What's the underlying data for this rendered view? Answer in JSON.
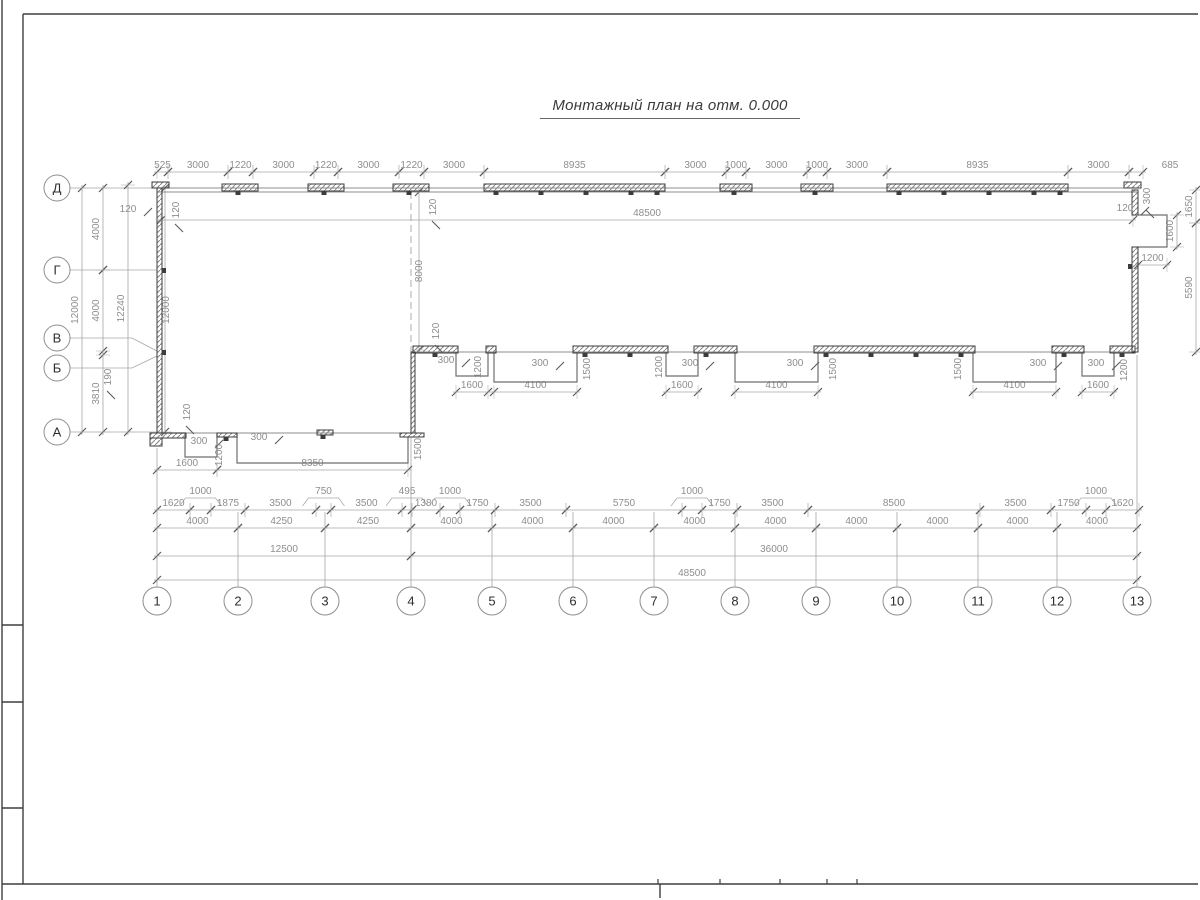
{
  "title": {
    "text": "Монтажный план на отм. 0.000"
  },
  "colors": {
    "wall": "#3c3c3c",
    "dim_line": "#a6a6a6",
    "tick": "#5a5a5a",
    "dim_text": "#8e8e8e",
    "axis_text": "#2f2f2f",
    "outline": "#6f6f6f",
    "frame": "#3f3f3f",
    "sheet_edge": "#9a9a9a",
    "hatch": "#8a8a8a"
  },
  "frame": {
    "lines": [
      [
        2,
        0,
        2,
        900
      ],
      [
        23,
        14,
        1198,
        14
      ],
      [
        23,
        14,
        23,
        884
      ],
      [
        2,
        884,
        1198,
        884
      ],
      [
        2,
        625,
        23,
        625
      ],
      [
        2,
        702,
        23,
        702
      ],
      [
        2,
        808,
        23,
        808
      ],
      [
        660,
        884,
        660,
        898
      ]
    ],
    "ticks_x": [
      658,
      720,
      780,
      827,
      857
    ],
    "ticks_y": 884
  },
  "axes": {
    "bottom": {
      "y": 601,
      "r": 14,
      "items": [
        {
          "label": "1",
          "x": 157
        },
        {
          "label": "2",
          "x": 238
        },
        {
          "label": "3",
          "x": 325
        },
        {
          "label": "4",
          "x": 411
        },
        {
          "label": "5",
          "x": 492
        },
        {
          "label": "6",
          "x": 573
        },
        {
          "label": "7",
          "x": 654
        },
        {
          "label": "8",
          "x": 735
        },
        {
          "label": "9",
          "x": 816
        },
        {
          "label": "10",
          "x": 897
        },
        {
          "label": "11",
          "x": 978
        },
        {
          "label": "12",
          "x": 1057
        },
        {
          "label": "13",
          "x": 1137
        }
      ]
    },
    "left": {
      "x": 57,
      "r": 13,
      "items": [
        {
          "label": "Д",
          "y": 188
        },
        {
          "label": "Г",
          "y": 270
        },
        {
          "label": "В",
          "y": 338
        },
        {
          "label": "Б",
          "y": 368
        },
        {
          "label": "А",
          "y": 432
        }
      ]
    }
  },
  "axis_lines": {
    "bottom_tops": [
      [
        157,
        448
      ],
      [
        238,
        512
      ],
      [
        325,
        512
      ],
      [
        411,
        437
      ],
      [
        492,
        512
      ],
      [
        573,
        512
      ],
      [
        654,
        512
      ],
      [
        735,
        512
      ],
      [
        816,
        512
      ],
      [
        897,
        512
      ],
      [
        978,
        512
      ],
      [
        1057,
        512
      ],
      [
        1137,
        355
      ]
    ],
    "bottom_end_y": 587,
    "left_leaders": [
      "70,188 157,188",
      "70,270 157,270",
      "70,338 132,338 157,351",
      "70,368 132,368 157,356",
      "70,432 157,432"
    ]
  },
  "chains": [
    {
      "o": "h",
      "p": 172,
      "segs": [
        [
          157,
          168,
          "525"
        ],
        [
          168,
          228,
          "3000"
        ],
        [
          228,
          253,
          "1220"
        ],
        [
          253,
          314,
          "3000"
        ],
        [
          314,
          338,
          "1220"
        ],
        [
          338,
          399,
          "3000"
        ],
        [
          399,
          424,
          "1220"
        ],
        [
          424,
          484,
          "3000"
        ],
        [
          484,
          665,
          "8935"
        ],
        [
          665,
          726,
          "3000"
        ],
        [
          726,
          746,
          "1000"
        ],
        [
          746,
          807,
          "3000"
        ],
        [
          807,
          827,
          "1000"
        ],
        [
          827,
          887,
          "3000"
        ],
        [
          887,
          1068,
          "8935"
        ],
        [
          1068,
          1129,
          "3000"
        ],
        [
          1129,
          1143,
          "685",
          1170
        ]
      ]
    },
    {
      "o": "h",
      "p": 220,
      "segs": [
        [
          161,
          1133,
          "48500",
          647
        ]
      ]
    },
    {
      "o": "h",
      "p": 510,
      "segs": [
        [
          157,
          190,
          "1620"
        ],
        [
          190,
          211,
          "1000",
          "r"
        ],
        [
          211,
          245,
          "1875"
        ],
        [
          245,
          316,
          "3500"
        ],
        [
          316,
          331,
          "750",
          "r"
        ],
        [
          331,
          402,
          "3500"
        ],
        [
          402,
          412,
          "495",
          "r"
        ],
        [
          412,
          440,
          "1380"
        ],
        [
          440,
          460,
          "1000",
          "r"
        ],
        [
          460,
          495,
          "1750"
        ],
        [
          495,
          566,
          "3500"
        ],
        [
          566,
          682,
          "5750"
        ],
        [
          682,
          702,
          "1000",
          "r"
        ],
        [
          702,
          737,
          "1750"
        ],
        [
          737,
          808,
          "3500"
        ],
        [
          808,
          980,
          "8500"
        ],
        [
          980,
          1051,
          "3500"
        ],
        [
          1051,
          1086,
          "1750"
        ],
        [
          1086,
          1106,
          "1000",
          "r"
        ],
        [
          1106,
          1139,
          "1620"
        ]
      ]
    },
    {
      "o": "h",
      "p": 528,
      "segs": [
        [
          157,
          238,
          "4000"
        ],
        [
          238,
          325,
          "4250"
        ],
        [
          325,
          411,
          "4250"
        ],
        [
          411,
          492,
          "4000"
        ],
        [
          492,
          573,
          "4000"
        ],
        [
          573,
          654,
          "4000"
        ],
        [
          654,
          735,
          "4000"
        ],
        [
          735,
          816,
          "4000"
        ],
        [
          816,
          897,
          "4000"
        ],
        [
          897,
          978,
          "4000"
        ],
        [
          978,
          1057,
          "4000"
        ],
        [
          1057,
          1137,
          "4000"
        ]
      ]
    },
    {
      "o": "h",
      "p": 556,
      "segs": [
        [
          157,
          411,
          "12500"
        ],
        [
          411,
          1137,
          "36000"
        ]
      ]
    },
    {
      "o": "h",
      "p": 580,
      "segs": [
        [
          157,
          1137,
          "48500",
          692
        ]
      ]
    },
    {
      "o": "v",
      "p": 82,
      "segs": [
        [
          188,
          432,
          "12000"
        ]
      ]
    },
    {
      "o": "v",
      "p": 103,
      "segs": [
        [
          188,
          270,
          "4000"
        ],
        [
          270,
          351,
          "4000"
        ],
        [
          355,
          432,
          "3810"
        ]
      ]
    },
    {
      "o": "v",
      "p": 128,
      "segs": [
        [
          185,
          432,
          "12240"
        ]
      ]
    },
    {
      "o": "v",
      "p": 165,
      "lo": 8,
      "segs": [
        [
          188,
          432,
          "12000"
        ]
      ]
    },
    {
      "o": "v",
      "p": 1196,
      "segs": [
        [
          190,
          223,
          "1650"
        ],
        [
          223,
          352,
          "5590"
        ]
      ]
    },
    {
      "o": "v",
      "p": 1177,
      "segs": [
        [
          215,
          247,
          "1600"
        ]
      ]
    },
    {
      "o": "v",
      "p": 419,
      "lo": 7,
      "segs": [
        [
          192,
          350,
          "8000"
        ]
      ]
    },
    {
      "o": "h",
      "p": 265,
      "segs": [
        [
          1138,
          1167,
          "1200"
        ]
      ]
    },
    {
      "o": "h",
      "p": 392,
      "segs": [
        [
          456,
          488,
          "1600"
        ],
        [
          494,
          577,
          "4100"
        ]
      ]
    },
    {
      "o": "h",
      "p": 392,
      "segs": [
        [
          666,
          698,
          "1600"
        ],
        [
          735,
          818,
          "4100"
        ]
      ]
    },
    {
      "o": "h",
      "p": 392,
      "segs": [
        [
          973,
          1056,
          "4100"
        ],
        [
          1082,
          1114,
          "1600"
        ]
      ]
    },
    {
      "o": "h",
      "p": 470,
      "segs": [
        [
          157,
          217,
          "1600"
        ],
        [
          217,
          408,
          "8350"
        ]
      ]
    }
  ],
  "float_labels": [
    [
      "120",
      128,
      212,
      0,
      1
    ],
    [
      "120",
      179,
      210,
      1,
      1
    ],
    [
      "120",
      436,
      207,
      1,
      1
    ],
    [
      "120",
      439,
      331,
      1,
      1
    ],
    [
      "120",
      1125,
      211,
      0,
      1
    ],
    [
      "120",
      190,
      412,
      1,
      1
    ],
    [
      "300",
      199,
      444,
      0,
      1
    ],
    [
      "300",
      259,
      440,
      0,
      1
    ],
    [
      "1200",
      222,
      455,
      1,
      0
    ],
    [
      "1500",
      421,
      449,
      1,
      0
    ],
    [
      "300",
      446,
      363,
      0,
      1
    ],
    [
      "1200",
      481,
      367,
      1,
      0
    ],
    [
      "300",
      540,
      366,
      0,
      1
    ],
    [
      "1500",
      590,
      369,
      1,
      0
    ],
    [
      "1200",
      662,
      367,
      1,
      0
    ],
    [
      "300",
      690,
      366,
      0,
      1
    ],
    [
      "300",
      795,
      366,
      0,
      1
    ],
    [
      "1500",
      836,
      369,
      1,
      0
    ],
    [
      "1500",
      961,
      369,
      1,
      0
    ],
    [
      "300",
      1038,
      366,
      0,
      1
    ],
    [
      "300",
      1096,
      366,
      0,
      1
    ],
    [
      "1200",
      1127,
      370,
      1,
      0
    ],
    [
      "300",
      1150,
      196,
      1,
      1
    ],
    [
      "190",
      111,
      377,
      1,
      1
    ]
  ],
  "walls": {
    "hatch_rects": [
      [
        222,
        184,
        36,
        7
      ],
      [
        308,
        184,
        36,
        7
      ],
      [
        393,
        184,
        36,
        7
      ],
      [
        484,
        184,
        181,
        7
      ],
      [
        720,
        184,
        32,
        7
      ],
      [
        801,
        184,
        32,
        7
      ],
      [
        887,
        184,
        181,
        7
      ],
      [
        152,
        182,
        17,
        6
      ],
      [
        1124,
        182,
        17,
        6
      ],
      [
        157,
        188,
        5,
        245
      ],
      [
        150,
        433,
        36,
        5
      ],
      [
        150,
        438,
        12,
        8
      ],
      [
        217,
        433,
        20,
        4
      ],
      [
        317,
        430,
        16,
        5
      ],
      [
        411,
        352,
        4,
        81
      ],
      [
        400,
        433,
        24,
        4
      ],
      [
        413,
        346,
        45,
        7
      ],
      [
        486,
        346,
        10,
        7
      ],
      [
        573,
        346,
        95,
        7
      ],
      [
        694,
        346,
        43,
        7
      ],
      [
        814,
        346,
        161,
        7
      ],
      [
        1052,
        346,
        32,
        7
      ],
      [
        1110,
        346,
        25,
        7
      ],
      [
        1132,
        190,
        6,
        25
      ],
      [
        1132,
        247,
        6,
        105
      ]
    ],
    "tabs": [
      [
        238,
        191
      ],
      [
        324,
        191
      ],
      [
        409,
        191
      ],
      [
        734,
        191
      ],
      [
        815,
        191
      ],
      [
        496,
        191
      ],
      [
        541,
        191
      ],
      [
        586,
        191
      ],
      [
        631,
        191
      ],
      [
        657,
        191
      ],
      [
        899,
        191
      ],
      [
        944,
        191
      ],
      [
        989,
        191
      ],
      [
        1034,
        191
      ],
      [
        1060,
        191
      ],
      [
        435,
        353
      ],
      [
        585,
        353
      ],
      [
        630,
        353
      ],
      [
        706,
        353
      ],
      [
        826,
        353
      ],
      [
        871,
        353
      ],
      [
        916,
        353
      ],
      [
        961,
        353
      ],
      [
        1064,
        353
      ],
      [
        1122,
        353
      ],
      [
        323,
        435
      ],
      [
        226,
        437
      ]
    ],
    "side_tabs": [
      [
        162,
        268
      ],
      [
        162,
        350
      ],
      [
        1128,
        264
      ]
    ],
    "thin_lines": [
      [
        157,
        188,
        1137,
        188
      ],
      [
        157,
        192,
        1137,
        192
      ],
      [
        415,
        352,
        1133,
        352
      ],
      [
        157,
        433,
        411,
        433
      ]
    ],
    "outlines": [
      "161,433 185,433 185,457 217,457 217,433",
      "237,433 237,463 408,463 408,437",
      "456,352 456,376 488,376 488,352",
      "494,352 494,382 577,382 577,352",
      "666,352 666,376 698,376 698,352",
      "735,352 735,382 818,382 818,352",
      "973,352 973,382 1056,382 1056,352",
      "1082,352 1082,376 1114,376 1114,352",
      "1138,215 1167,215 1167,247 1138,247"
    ],
    "dashed": [
      [
        411,
        192,
        411,
        352
      ]
    ]
  }
}
